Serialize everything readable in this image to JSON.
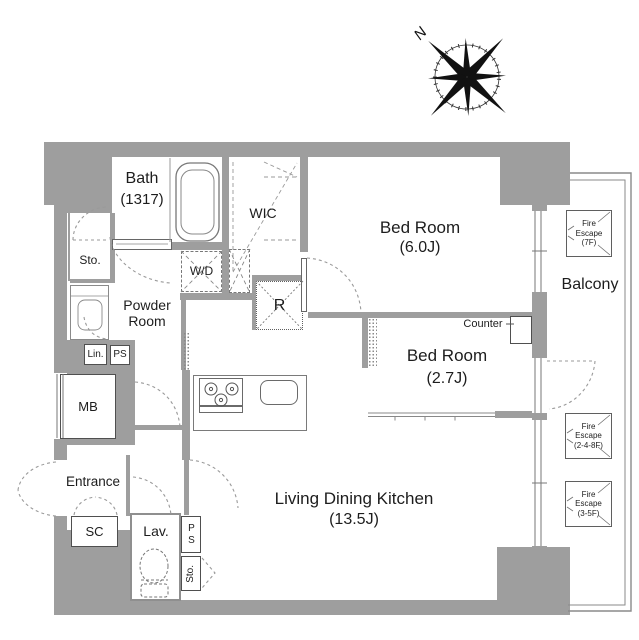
{
  "compass": {
    "north_label": "N"
  },
  "rooms": {
    "bath": {
      "name": "Bath",
      "size": "(1317)"
    },
    "wic": {
      "name": "WIC"
    },
    "bedroom_6j": {
      "name": "Bed Room",
      "size": "(6.0J)"
    },
    "bedroom_27j": {
      "name": "Bed Room",
      "size": "(2.7J)"
    },
    "ldk": {
      "name": "Living Dining Kitchen",
      "size": "(13.5J)"
    },
    "powder_room": {
      "name_line1": "Powder",
      "name_line2": "Room"
    },
    "balcony": {
      "name": "Balcony"
    },
    "entrance": {
      "name": "Entrance"
    },
    "lavatory": {
      "name": "Lav."
    }
  },
  "fixtures": {
    "storage_upper": "Sto.",
    "storage_lower": "Sto.",
    "linen": "Lin.",
    "pipe_space_upper": "PS",
    "pipe_space_lower": "PS",
    "meter_box": "MB",
    "shoe_closet": "SC",
    "washer_dryer": "W/D",
    "refrigerator": "R",
    "counter": "Counter"
  },
  "fire_escapes": [
    {
      "line1": "Fire",
      "line2": "Escape",
      "line3": "(7F)"
    },
    {
      "line1": "Fire",
      "line2": "Escape",
      "line3": "(2-4-8F)"
    },
    {
      "line1": "Fire",
      "line2": "Escape",
      "line3": "(3-5F)"
    }
  ],
  "colors": {
    "wall": "#9e9e9e",
    "line": "#8a8a8a",
    "edge": "#6f6f6f",
    "text": "#1d1d1d"
  }
}
